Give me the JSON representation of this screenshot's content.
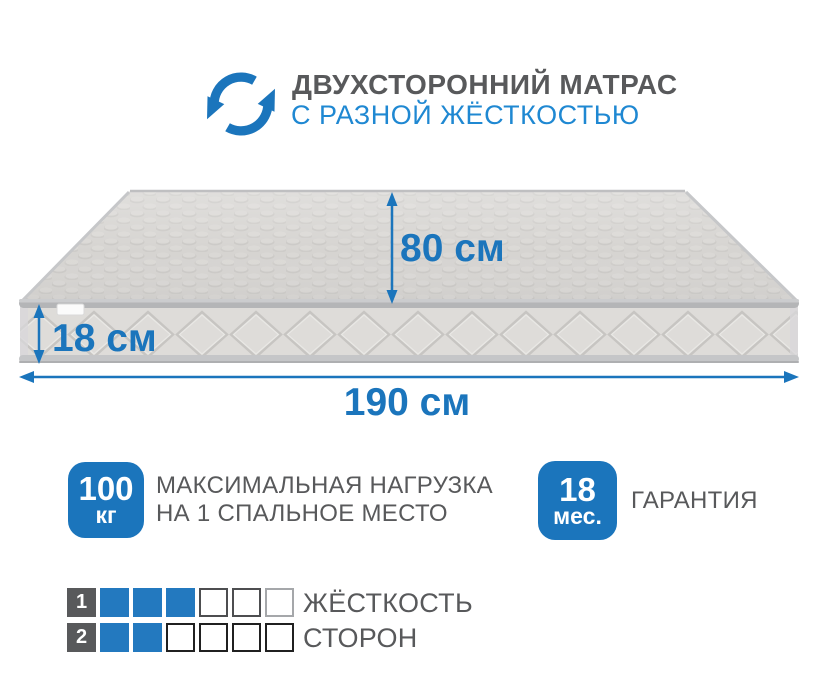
{
  "colors": {
    "accent": "#1b75bc",
    "subtitle_blue": "#1f88d2",
    "text_gray": "#58595b",
    "square_blue": "#2379bf"
  },
  "header": {
    "title": "ДВУХСТОРОННИЙ МАТРАС",
    "subtitle": "С РАЗНОЙ ЖЁСТКОСТЬЮ",
    "icon": "rotate-arrows-icon"
  },
  "mattress": {
    "width_label": "80 см",
    "thickness_label": "18 см",
    "length_label": "190 см"
  },
  "features": [
    {
      "badge_value": "100",
      "badge_unit": "кг",
      "label_line1": "МАКСИМАЛЬНАЯ НАГРУЗКА",
      "label_line2": "НА 1 СПАЛЬНОЕ МЕСТО"
    },
    {
      "badge_value": "18",
      "badge_unit": "мес.",
      "label_line1": "ГАРАНТИЯ",
      "label_line2": ""
    }
  ],
  "firmness": {
    "title_line1": "ЖЁСТКОСТЬ",
    "title_line2": "СТОРОН",
    "scale_max": 6,
    "rows": [
      {
        "number": "1",
        "filled": 3,
        "total": 6
      },
      {
        "number": "2",
        "filled": 2,
        "total": 6
      }
    ]
  }
}
